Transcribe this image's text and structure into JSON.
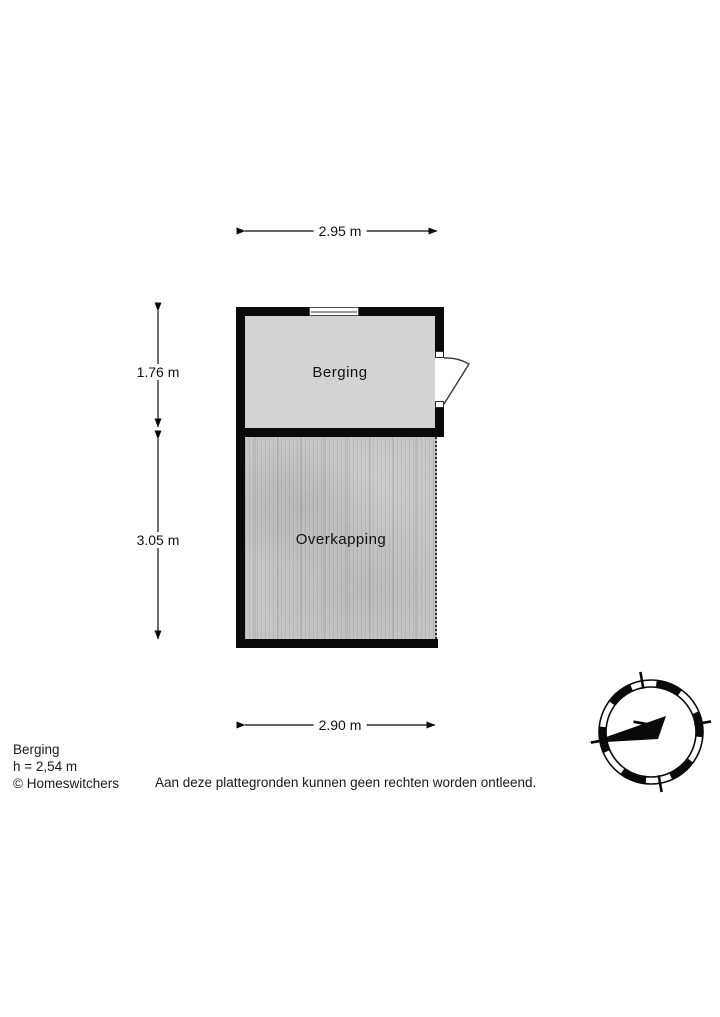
{
  "plan": {
    "dim_top": "2.95 m",
    "dim_left_upper": "1.76 m",
    "dim_left_lower": "3.05 m",
    "dim_bottom": "2.90 m",
    "rooms": {
      "berging": "Berging",
      "overkapping": "Overkapping"
    },
    "compass_north": "N"
  },
  "footer": {
    "name": "Berging",
    "height": "h = 2,54 m",
    "copyright": "© Homeswitchers",
    "disclaimer": "Aan deze plattegronden kunnen geen rechten worden ontleend."
  },
  "colors": {
    "wall": "#0a0a0a",
    "room_fill": "#d3d3d3",
    "deck_fill": "#c6c6c6"
  }
}
